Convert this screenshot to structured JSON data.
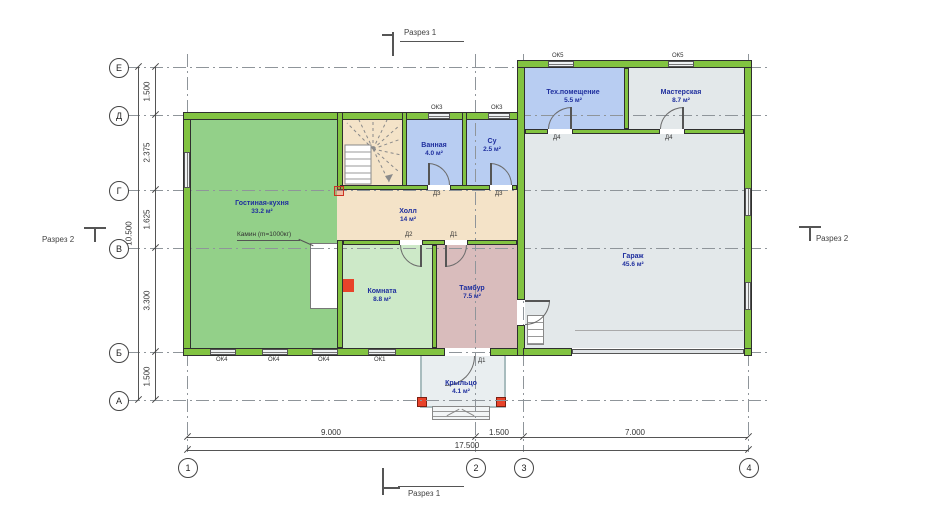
{
  "grid": {
    "row_labels": [
      "Е",
      "Д",
      "Г",
      "В",
      "Б",
      "А"
    ],
    "col_labels": [
      "1",
      "2",
      "3",
      "4"
    ]
  },
  "dimensions": {
    "left_segments": [
      "1.500",
      "2.375",
      "1.625",
      "3.300",
      "1.500"
    ],
    "left_total": "10.500",
    "bottom_segments": [
      "9.000",
      "1.500",
      "7.000"
    ],
    "bottom_total": "17.500"
  },
  "sections": {
    "s1": "Разрез 1",
    "s2": "Разрез 2"
  },
  "rooms": [
    {
      "name": "Гостиная-кухня",
      "area": "33.2 м²"
    },
    {
      "name": "Ванная",
      "area": "4.0 м²"
    },
    {
      "name": "Су",
      "area": "2.5 м²"
    },
    {
      "name": "Холл",
      "area": "14 м²"
    },
    {
      "name": "Комната",
      "area": "8.8 м²"
    },
    {
      "name": "Тамбур",
      "area": "7.5 м²"
    },
    {
      "name": "Тех.помещение",
      "area": "5.5 м²"
    },
    {
      "name": "Мастерская",
      "area": "8.7 м²"
    },
    {
      "name": "Гараж",
      "area": "45.6 м²"
    },
    {
      "name": "Крыльцо",
      "area": "4.1 м²"
    }
  ],
  "annotations": {
    "fireplace": "Камин (m=1000кг)"
  },
  "doors": {
    "d1": "Д1",
    "d2": "Д2",
    "d3": "Д3",
    "d4": "Д4"
  },
  "windows": {
    "ok1": "ОК1",
    "ok3": "ОК3",
    "ok4": "ОК4",
    "ok5": "ОК5"
  },
  "colors": {
    "wall_green": "#82c341",
    "living": "#93d089",
    "small_room": "#cde9c8",
    "wet_blue": "#b8cdf2",
    "hall_beige": "#f4e3c8",
    "tambur_pink": "#d9bcbc",
    "garage_gray": "#e3e8ea",
    "porch_gray": "#e9eef0",
    "label_blue": "#1f2f9e",
    "accent_red": "#e8432a"
  }
}
